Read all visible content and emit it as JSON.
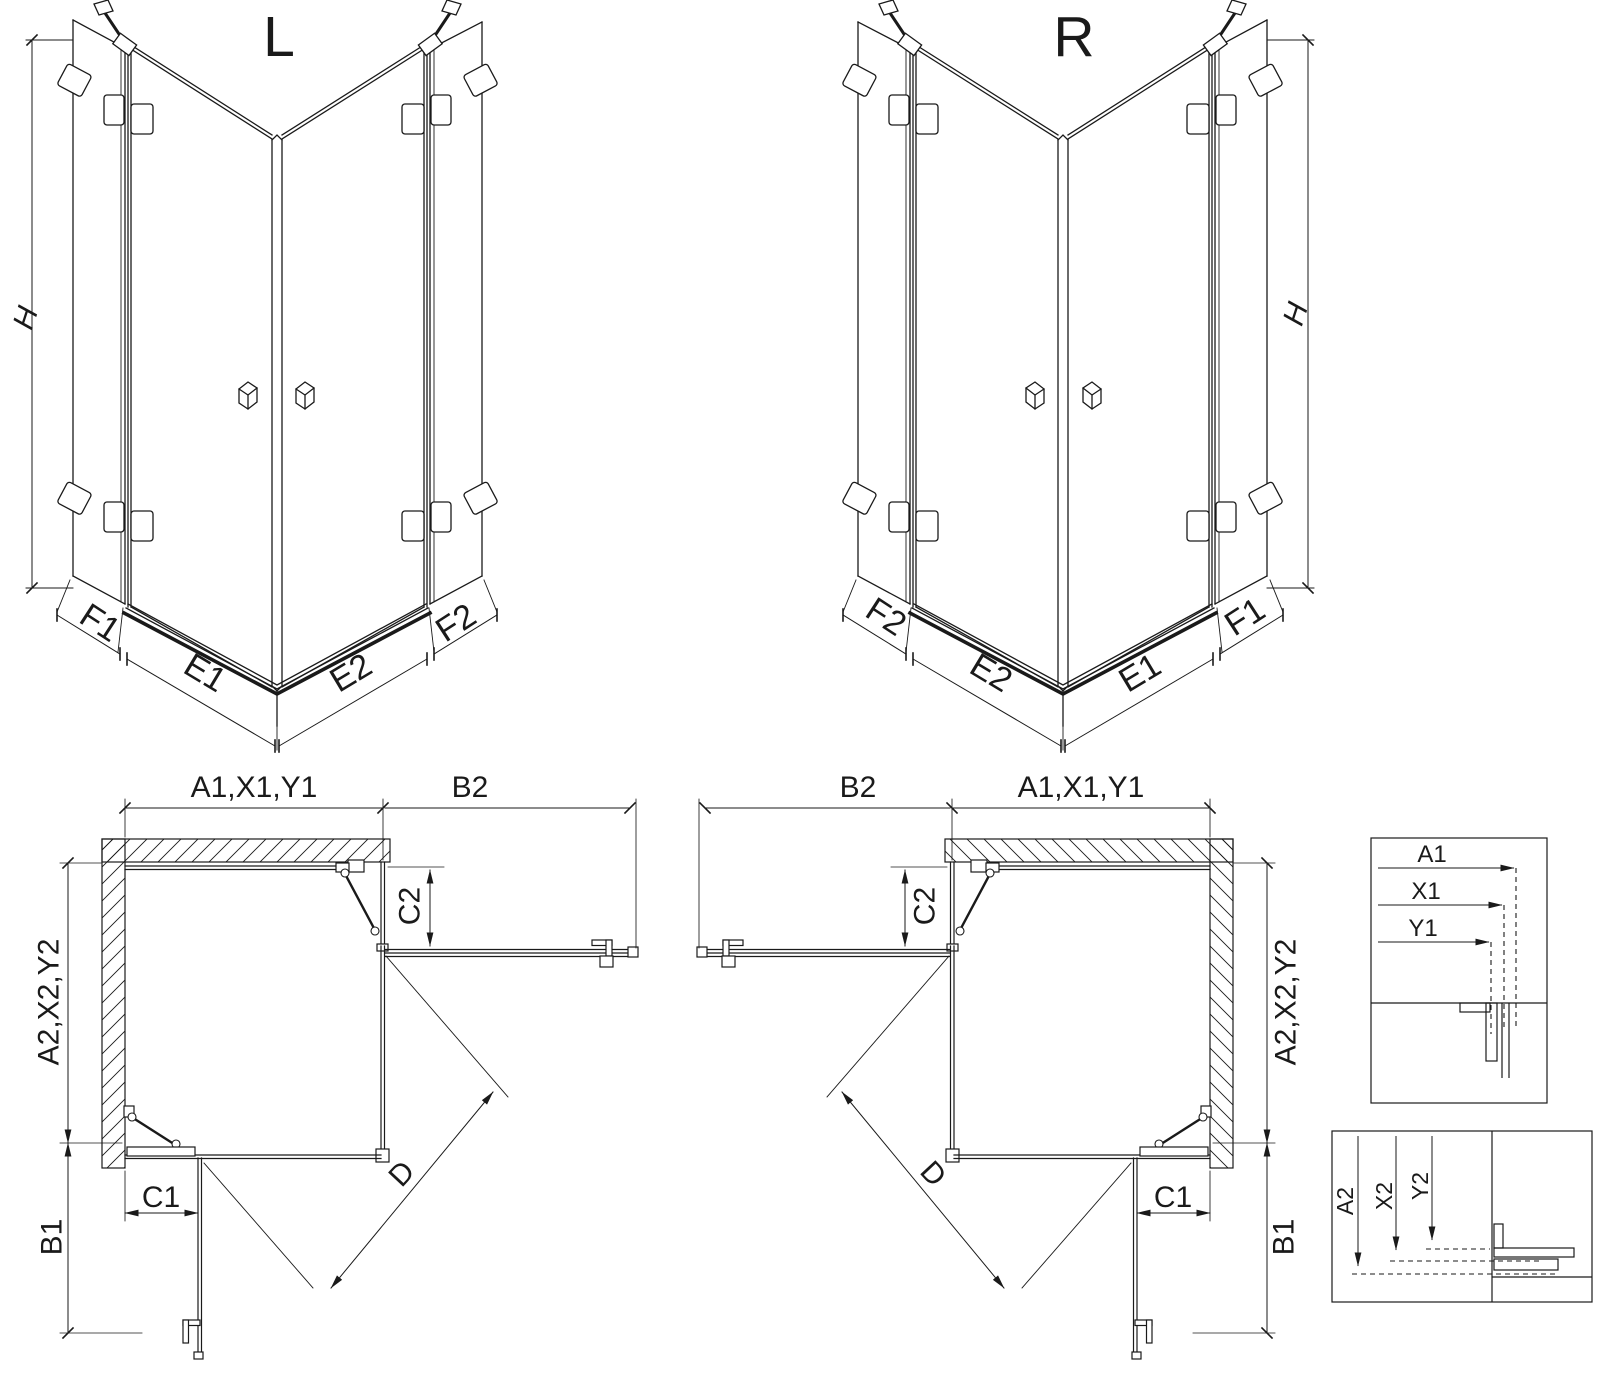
{
  "page": {
    "background": "#ffffff",
    "line_color": "#1a1a1a"
  },
  "views": {
    "left_3d": {
      "title": "L",
      "height": "H",
      "f1": "F1",
      "e1": "E1",
      "e2": "E2",
      "f2": "F2"
    },
    "right_3d": {
      "title": "R",
      "height": "H",
      "f2": "F2",
      "e2": "E2",
      "e1": "E1",
      "f1": "F1"
    },
    "left_plan": {
      "width": "A1,X1,Y1",
      "return_width": "B2",
      "depth": "A2,X2,Y2",
      "door_clear_top": "C2",
      "door_clear_side": "C1",
      "entry_width": "B1",
      "diagonal": "D"
    },
    "right_plan": {
      "return_width": "B2",
      "width": "A1,X1,Y1",
      "door_clear_top": "C2",
      "depth": "A2,X2,Y2",
      "diagonal": "D",
      "door_clear_side": "C1",
      "entry_width": "B1"
    },
    "detail_width": {
      "a1": "A1",
      "x1": "X1",
      "y1": "Y1"
    },
    "detail_depth": {
      "a2": "A2",
      "x2": "X2",
      "y2": "Y2"
    }
  }
}
